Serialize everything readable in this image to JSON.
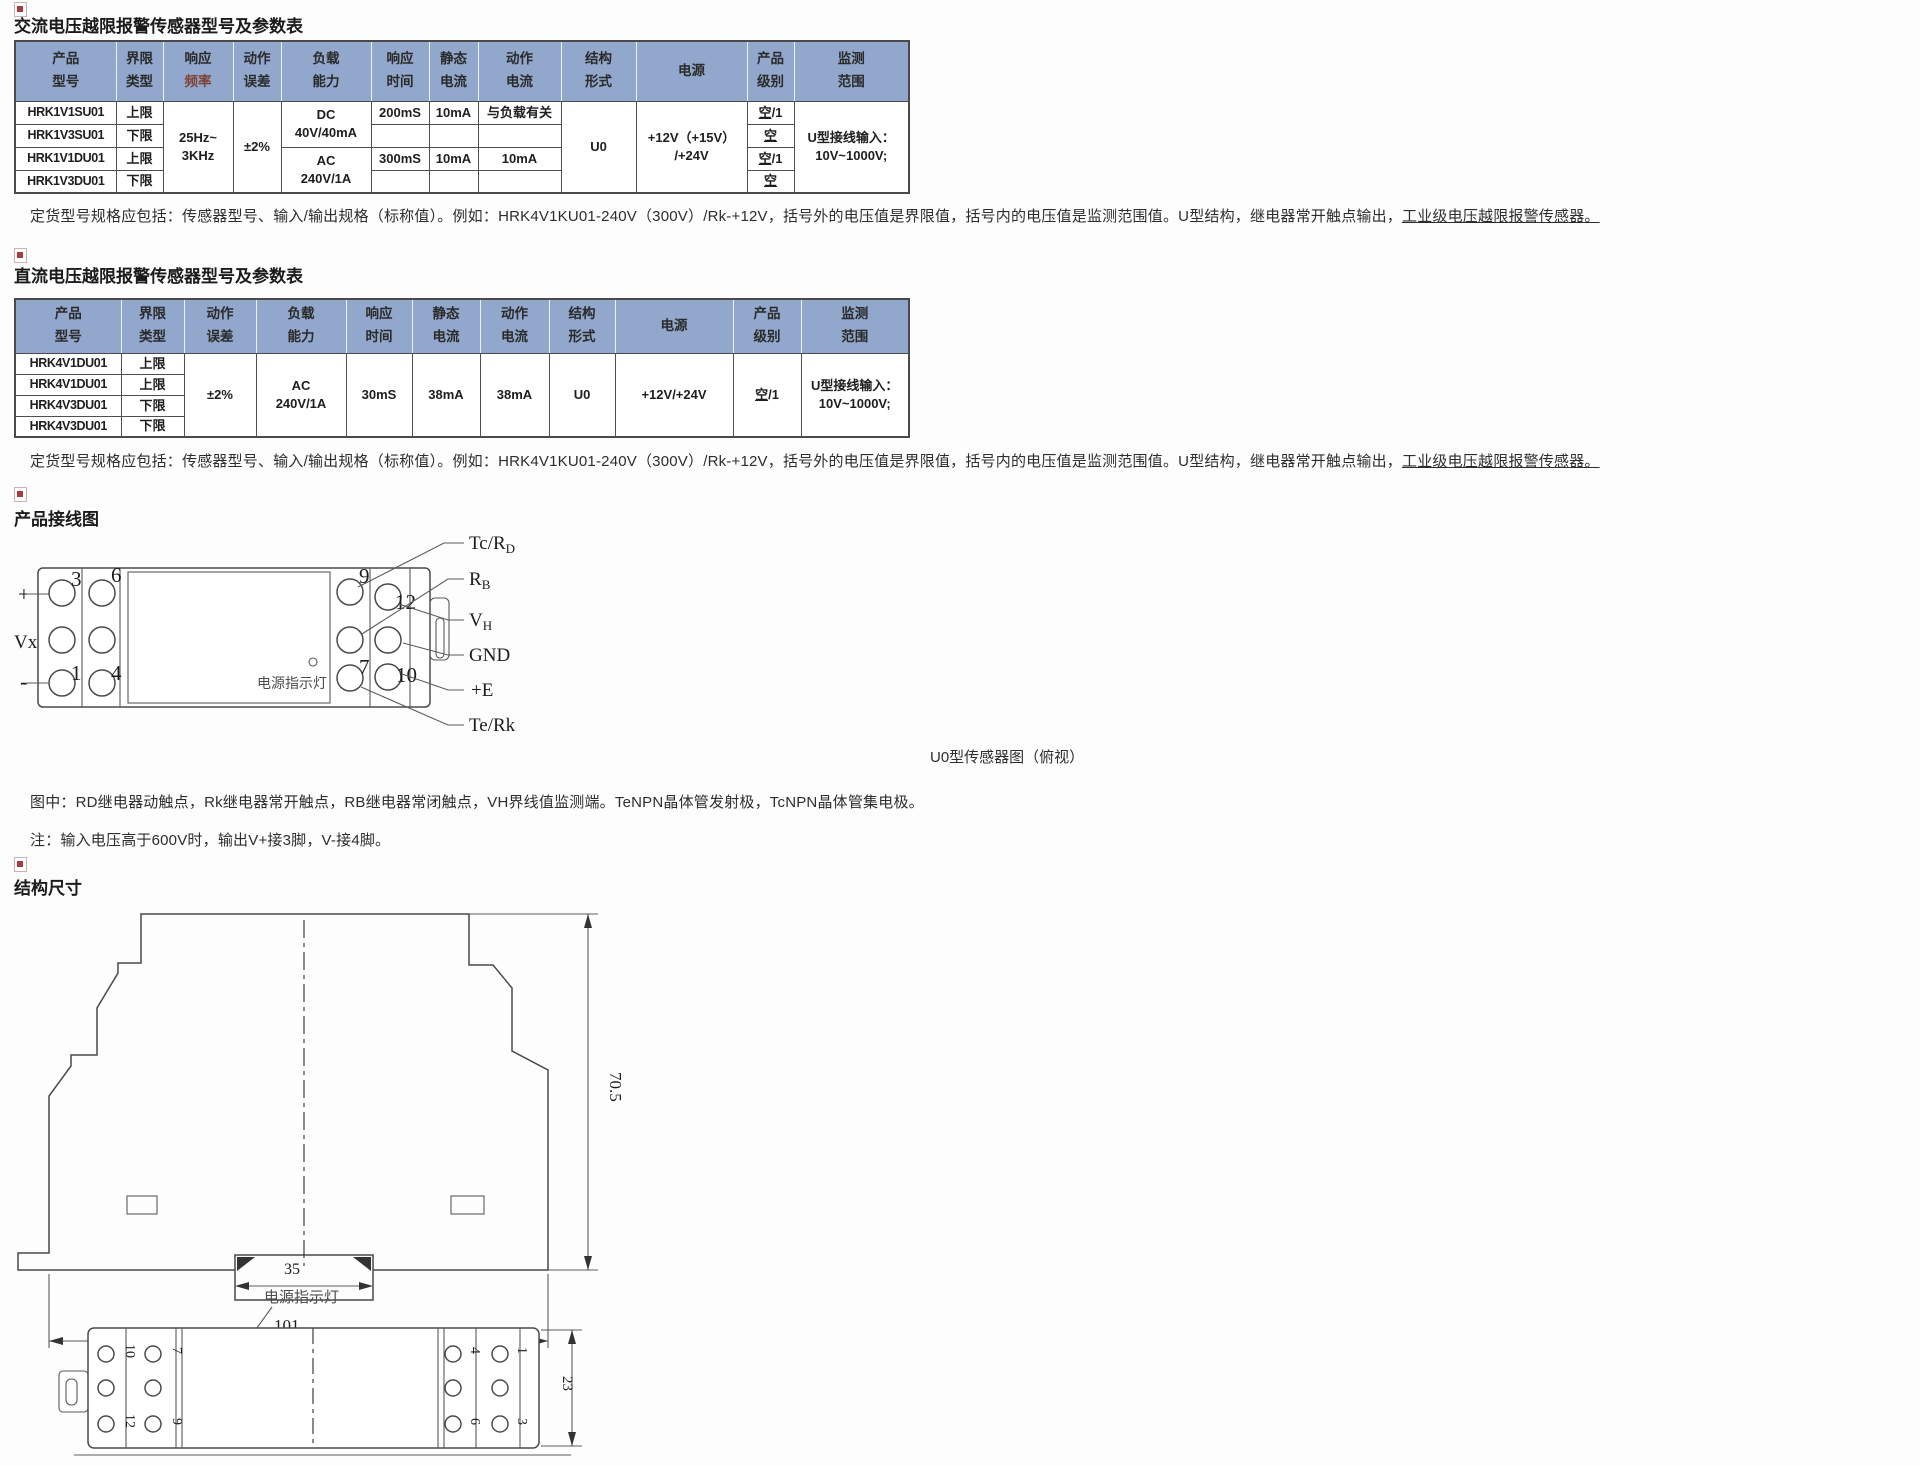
{
  "ac_section": {
    "title": "交流电压越限报警传感器型号及参数表",
    "table": {
      "headers": {
        "model": "产品\n型号",
        "limit": "界限\n类型",
        "freq_line1": "响应",
        "freq_line2": "频率",
        "error": "动作\n误差",
        "load": "负载\n能力",
        "resp": "响应\n时间",
        "static": "静态\n电流",
        "action": "动作\n电流",
        "struct": "结构\n形式",
        "power": "电源",
        "grade": "产品\n级别",
        "range": "监测\n范围"
      },
      "rows": [
        {
          "model": "HRK1V1SU01",
          "limit": "上限",
          "resp": "200mS",
          "static": "10mA",
          "action": "与负载有关",
          "grade_u": "空",
          "grade_rest": "/1"
        },
        {
          "model": "HRK1V3SU01",
          "limit": "下限",
          "resp": "",
          "static": "",
          "action": "",
          "grade_u": "空",
          "grade_rest": ""
        },
        {
          "model": "HRK1V1DU01",
          "limit": "上限",
          "resp": "300mS",
          "static": "10mA",
          "action": "10mA",
          "grade_u": "空",
          "grade_rest": "/1"
        },
        {
          "model": "HRK1V3DU01",
          "limit": "下限",
          "resp": "",
          "static": "",
          "action": "",
          "grade_u": "空",
          "grade_rest": ""
        }
      ],
      "merged": {
        "freq": "25Hz~\n3KHz",
        "error": "±2%",
        "load_top": "DC\n40V/40mA",
        "load_bottom": "AC\n240V/1A",
        "struct": "U0",
        "power": "+12V（+15V）\n/+24V",
        "range": "U型接线输入：\n10V~1000V;"
      }
    },
    "note_main": "定货型号规格应包括：传感器型号、输入/输出规格（标称值）。例如：HRK4V1KU01-240V（300V）/Rk-+12V，括号外的电压值是界限值，括号内的电压值是监测范围值。U型结构，继电器常开触点输出，",
    "note_underline": "工业级电压越限报警传感器。"
  },
  "dc_section": {
    "title": "直流电压越限报警传感器型号及参数表",
    "table": {
      "headers": {
        "model": "产品\n型号",
        "limit": "界限\n类型",
        "error": "动作\n误差",
        "load": "负载\n能力",
        "resp": "响应\n时间",
        "static": "静态\n电流",
        "action": "动作\n电流",
        "struct": "结构\n形式",
        "power": "电源",
        "grade": "产品\n级别",
        "range": "监测\n范围"
      },
      "rows": [
        {
          "model": "HRK4V1DU01",
          "limit": "上限"
        },
        {
          "model": "HRK4V1DU01",
          "limit": "上限"
        },
        {
          "model": "HRK4V3DU01",
          "limit": "下限"
        },
        {
          "model": "HRK4V3DU01",
          "limit": "下限"
        }
      ],
      "merged": {
        "error": "±2%",
        "load": "AC\n240V/1A",
        "resp": "30mS",
        "static": "38mA",
        "action": "38mA",
        "struct": "U0",
        "power": "+12V/+24V",
        "grade_u": "空",
        "grade_rest": "/1",
        "range": "U型接线输入：\n10V~1000V;"
      }
    },
    "note_main": "定货型号规格应包括：传感器型号、输入/输出规格（标称值）。例如：HRK4V1KU01-240V（300V）/Rk-+12V，括号外的电压值是界限值，括号内的电压值是监测范围值。U型结构，继电器常开触点输出，",
    "note_underline": "工业级电压越限报警传感器。"
  },
  "wiring": {
    "heading": "产品接线图",
    "caption": "U0型传感器图（俯视）",
    "led_label": "电源指示灯",
    "left_labels": {
      "plus": "+",
      "vx": "Vx",
      "minus": "-"
    },
    "terminals": {
      "t3": "3",
      "t6": "6",
      "t1": "1",
      "t4": "4",
      "t9": "9",
      "t12": "12",
      "t7": "7",
      "t10": "10"
    },
    "right_labels": {
      "tc_main": "Tc/R",
      "tc_sub": "D",
      "rb_main": "R",
      "rb_sub": "B",
      "vh_main": "V",
      "vh_sub": "H",
      "gnd": "GND",
      "pe": "+E",
      "terk": "Te/Rk"
    },
    "note_diagram": "图中：RD继电器动触点，Rk继电器常开触点，RB继电器常闭触点，VH界线值监测端。TeNPN晶体管发射极，TcNPN晶体管集电极。",
    "note_voltage": "注：输入电压高于600V时，输出V+接3脚，V-接4脚。"
  },
  "dimensions": {
    "heading": "结构尺寸",
    "height": "70.5",
    "slot_width": "35",
    "width": "101",
    "depth": "23",
    "led_label": "电源指示灯",
    "top_view_terminals": {
      "t10": "10",
      "t7": "7",
      "t12": "12",
      "t9": "9",
      "t4": "4",
      "t1": "1",
      "t6": "6",
      "t3": "3"
    }
  },
  "colors": {
    "header_bg": "#91a7cb",
    "freq_red": "#7d4338",
    "accent_red": "#a93c3c"
  }
}
